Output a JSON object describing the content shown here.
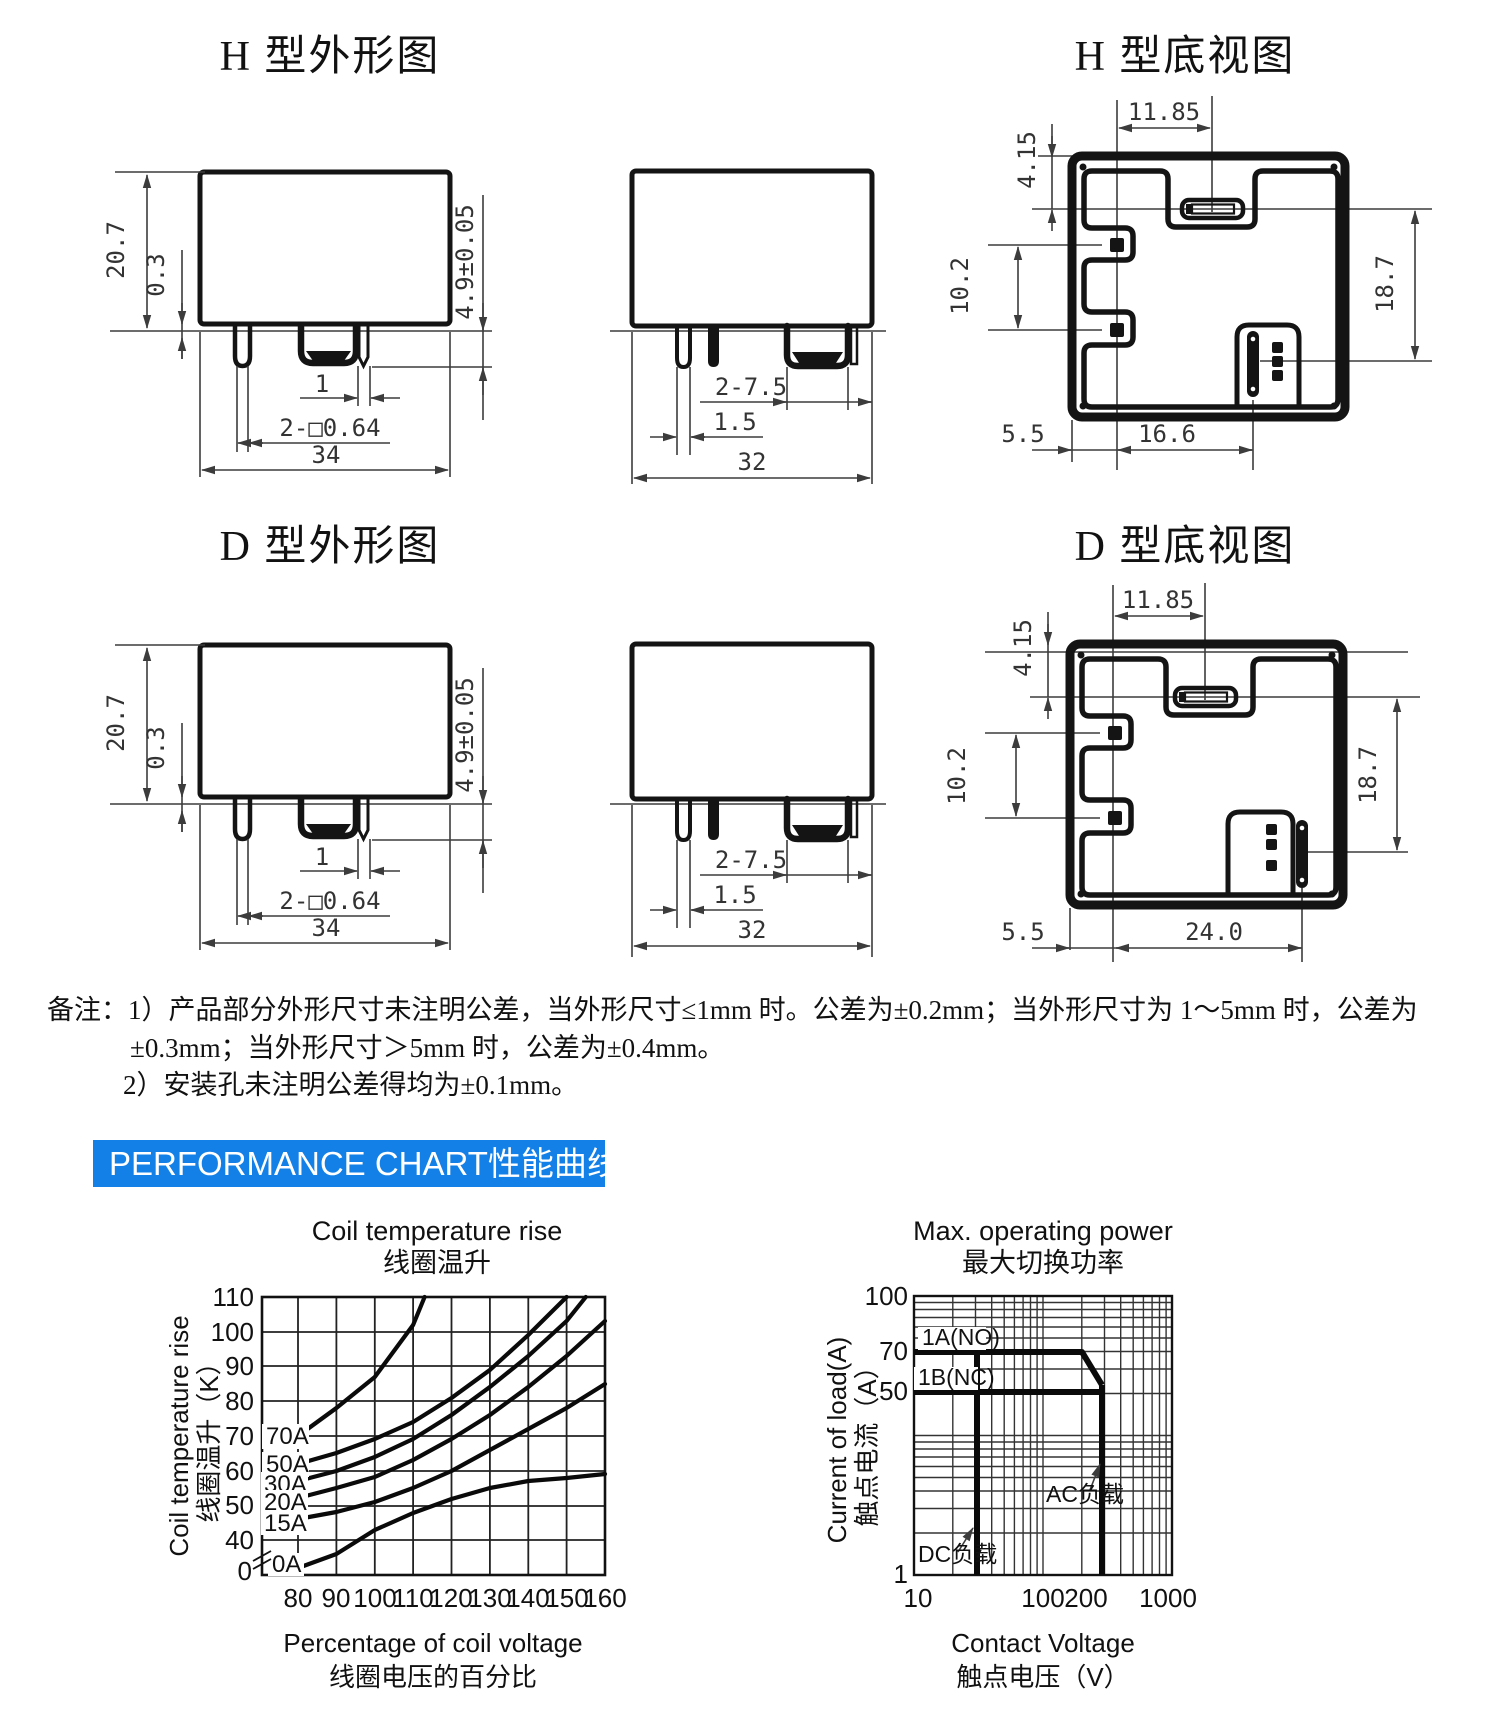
{
  "titles": {
    "h_outline": "H 型外形图",
    "h_bottom": "H 型底视图",
    "d_outline": "D 型外形图",
    "d_bottom": "D 型底视图"
  },
  "drawings": {
    "h_front": {
      "height": "20.7",
      "base": "0.3",
      "pin_length": "4.9±0.05",
      "pin_gap": "1",
      "pin_square": "2-□0.64",
      "width": "34"
    },
    "h_side": {
      "tab_width": "2-7.5",
      "pin_width": "1.5",
      "depth": "32"
    },
    "h_bottom": {
      "pitch": "11.85",
      "slot_offset": "4.15",
      "pad_pitch": "10.2",
      "span": "18.7",
      "edge_offset": "5.5",
      "slot_pitch": "16.6"
    },
    "d_front": {
      "height": "20.7",
      "base": "0.3",
      "pin_length": "4.9±0.05",
      "pin_gap": "1",
      "pin_square": "2-□0.64",
      "width": "34"
    },
    "d_side": {
      "tab_width": "2-7.5",
      "pin_width": "1.5",
      "depth": "32"
    },
    "d_bottom": {
      "pitch": "11.85",
      "slot_offset": "4.15",
      "pad_pitch": "10.2",
      "span": "18.7",
      "edge_offset": "5.5",
      "slot_pitch": "24.0"
    }
  },
  "notes": {
    "line1": "备注：1）产品部分外形尺寸未注明公差，当外形尺寸≤1mm 时。公差为±0.2mm；当外形尺寸为 1～5mm 时，公差为",
    "line2": "±0.3mm；当外形尺寸＞5mm 时，公差为±0.4mm。",
    "line3": "2）安装孔未注明公差得均为±0.1mm。"
  },
  "banner": {
    "text": "PERFORMANCE CHART性能曲线图",
    "bg": "#1380e8"
  },
  "chart_data": [
    {
      "type": "line",
      "title": "Coil temperature rise",
      "title_zh": "线圈温升",
      "xlabel": "Percentage of coil voltage",
      "xlabel_zh": "线圈电压的百分比",
      "ylabel": "Coil temperature rise",
      "ylabel_zh": "线圈温升（K）",
      "x_ticks": [
        80,
        90,
        100,
        110,
        120,
        130,
        140,
        150,
        160
      ],
      "y_ticks": [
        0,
        40,
        50,
        60,
        70,
        80,
        90,
        100,
        110
      ],
      "y_axis_break": true,
      "grid": true,
      "xlim": [
        80,
        160
      ],
      "ylim": [
        0,
        110
      ],
      "series": [
        {
          "name": "70A",
          "points": [
            [
              80,
              70
            ],
            [
              90,
              78
            ],
            [
              100,
              87
            ],
            [
              110,
              102
            ],
            [
              113,
              110
            ]
          ]
        },
        {
          "name": "50A",
          "points": [
            [
              80,
              62
            ],
            [
              90,
              65
            ],
            [
              100,
              69
            ],
            [
              110,
              74
            ],
            [
              120,
              81
            ],
            [
              130,
              89
            ],
            [
              140,
              99
            ],
            [
              150,
              110
            ]
          ]
        },
        {
          "name": "30A",
          "points": [
            [
              80,
              57
            ],
            [
              90,
              60
            ],
            [
              100,
              64
            ],
            [
              110,
              69
            ],
            [
              120,
              76
            ],
            [
              130,
              84
            ],
            [
              140,
              93
            ],
            [
              150,
              103
            ],
            [
              155,
              110
            ]
          ]
        },
        {
          "name": "20A",
          "points": [
            [
              80,
              52
            ],
            [
              90,
              55
            ],
            [
              100,
              58
            ],
            [
              110,
              63
            ],
            [
              120,
              69
            ],
            [
              130,
              76
            ],
            [
              140,
              84
            ],
            [
              150,
              93
            ],
            [
              160,
              103
            ]
          ]
        },
        {
          "name": "15A",
          "points": [
            [
              80,
              46
            ],
            [
              90,
              48
            ],
            [
              100,
              51
            ],
            [
              110,
              55
            ],
            [
              120,
              60
            ],
            [
              130,
              66
            ],
            [
              140,
              72
            ],
            [
              150,
              78
            ],
            [
              160,
              85
            ]
          ]
        },
        {
          "name": "0A",
          "points": [
            [
              80,
              8
            ],
            [
              90,
              24
            ],
            [
              100,
              43
            ],
            [
              110,
              48
            ],
            [
              120,
              52
            ],
            [
              130,
              55
            ],
            [
              140,
              57
            ],
            [
              150,
              58
            ],
            [
              160,
              59
            ]
          ]
        }
      ]
    },
    {
      "type": "line",
      "scale": "log-log",
      "title": "Max. operating power",
      "title_zh": "最大切换功率",
      "xlabel": "Contact Voltage",
      "xlabel_zh": "触点电压（V）",
      "ylabel": "Current of load(A)",
      "ylabel_zh": "触点电流（A）",
      "x_ticks": [
        10,
        100,
        200,
        1000
      ],
      "y_ticks": [
        1,
        50,
        70,
        100
      ],
      "xlim": [
        10,
        1000
      ],
      "ylim": [
        1,
        100
      ],
      "grid": true,
      "series": [
        {
          "name": "1A(NO)",
          "points": [
            [
              10,
              70
            ],
            [
              200,
              70
            ],
            [
              280,
              53
            ]
          ]
        },
        {
          "name": "1B(NC)",
          "points": [
            [
              10,
              50
            ],
            [
              280,
              50
            ]
          ]
        },
        {
          "name": "DC负载",
          "points": [
            [
              30,
              1
            ],
            [
              30,
              70
            ]
          ]
        },
        {
          "name": "AC负载",
          "points": [
            [
              280,
              1
            ],
            [
              280,
              53
            ]
          ]
        }
      ]
    }
  ]
}
